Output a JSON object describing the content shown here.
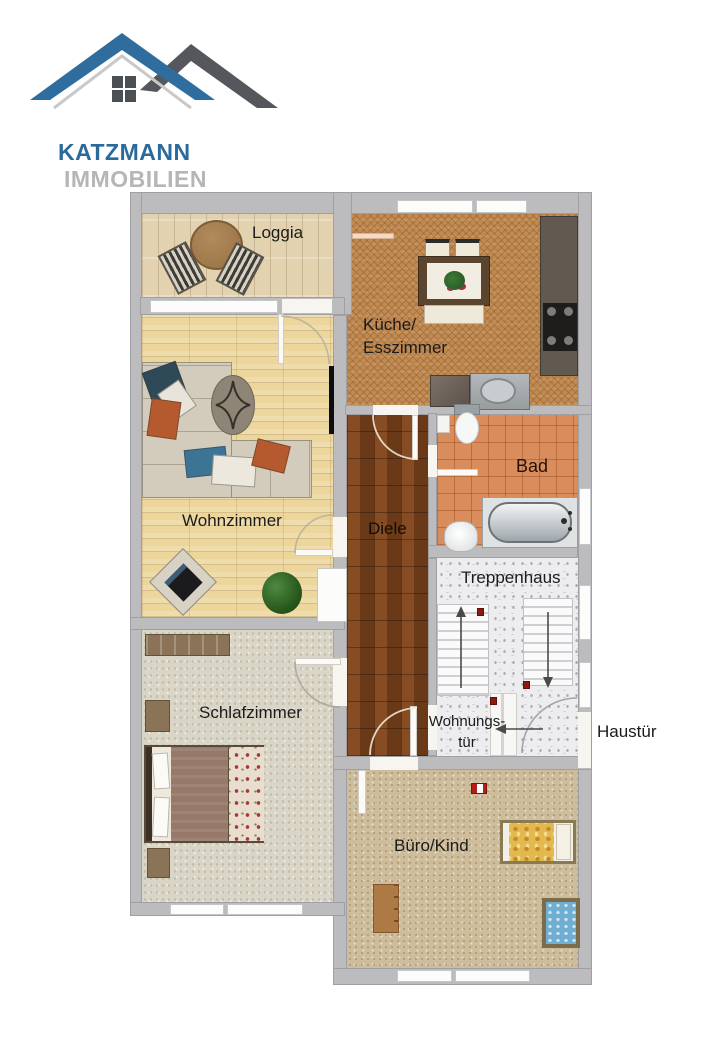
{
  "logo": {
    "brand": "KATZMANN",
    "suffix": "IMMOBILIEN",
    "brand_color": "#2b6b9c",
    "suffix_color": "#b4b6b8"
  },
  "rooms": {
    "loggia": {
      "label": "Loggia",
      "floor_color": "#e2d2b0"
    },
    "kueche": {
      "label_line1": "Küche/",
      "label_line2": "Esszimmer",
      "floor_color": "#c08a52"
    },
    "wohnzimmer": {
      "label": "Wohnzimmer",
      "floor_color": "#ecd69c"
    },
    "diele": {
      "label": "Diele",
      "floor_color": "#76401b"
    },
    "bad": {
      "label": "Bad",
      "floor_color": "#d98d5c"
    },
    "treppenhaus": {
      "label": "Treppenhaus",
      "floor_color": "#ededef"
    },
    "schlafzimmer": {
      "label": "Schlafzimmer",
      "floor_color": "#d9d5c7"
    },
    "buero": {
      "label": "Büro/Kind",
      "floor_color": "#cebd9c"
    }
  },
  "doors": {
    "wohnungstuer": {
      "label_line1": "Wohnungs-",
      "label_line2": "tür"
    },
    "haustuer": {
      "label": "Haustür"
    }
  },
  "colors": {
    "wall": "#bcbcbe",
    "loggia": "#e2d2b0",
    "kueche": "#c08a52",
    "wz": "#ecd69c",
    "diele": "#76401b",
    "bad": "#d98d5c",
    "trepp": "#ededef",
    "sz": "#d9d5c7",
    "buero": "#cebd9c"
  }
}
